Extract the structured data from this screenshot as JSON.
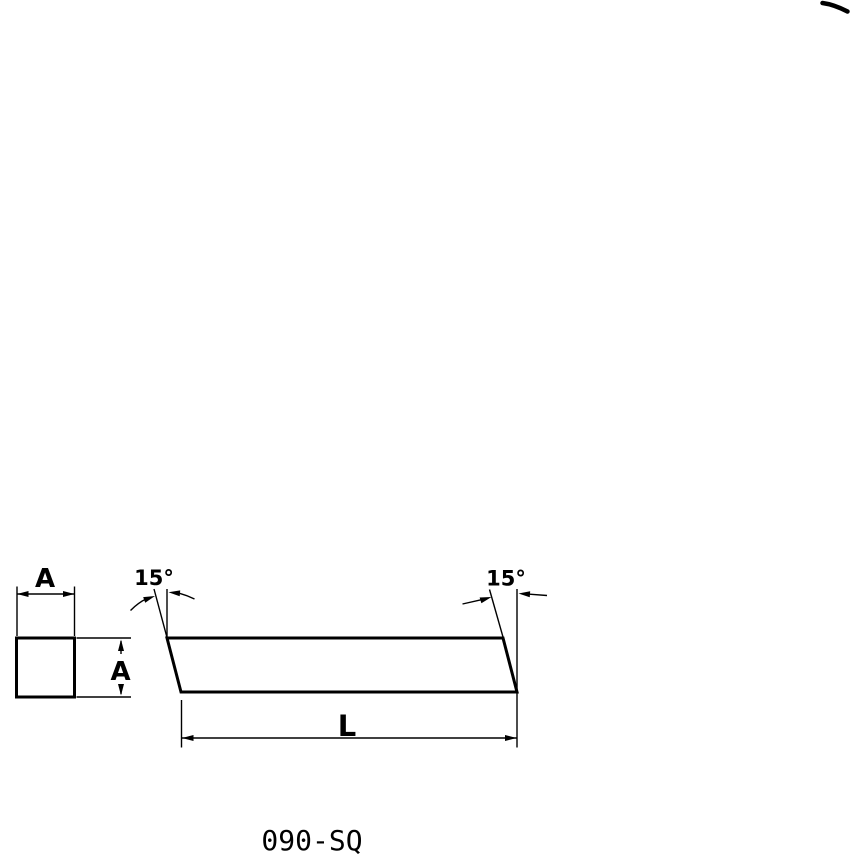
{
  "page": {
    "background_color": "#ffffff",
    "line_color": "#000000"
  },
  "drawing": {
    "part_number": "090-SQ",
    "front_view": {
      "shape": "square",
      "width_label": "A",
      "height_label": "A"
    },
    "side_view": {
      "shape": "parallelogram",
      "length_label": "L",
      "left_angle_label": "15°",
      "right_angle_label": "15°"
    }
  }
}
